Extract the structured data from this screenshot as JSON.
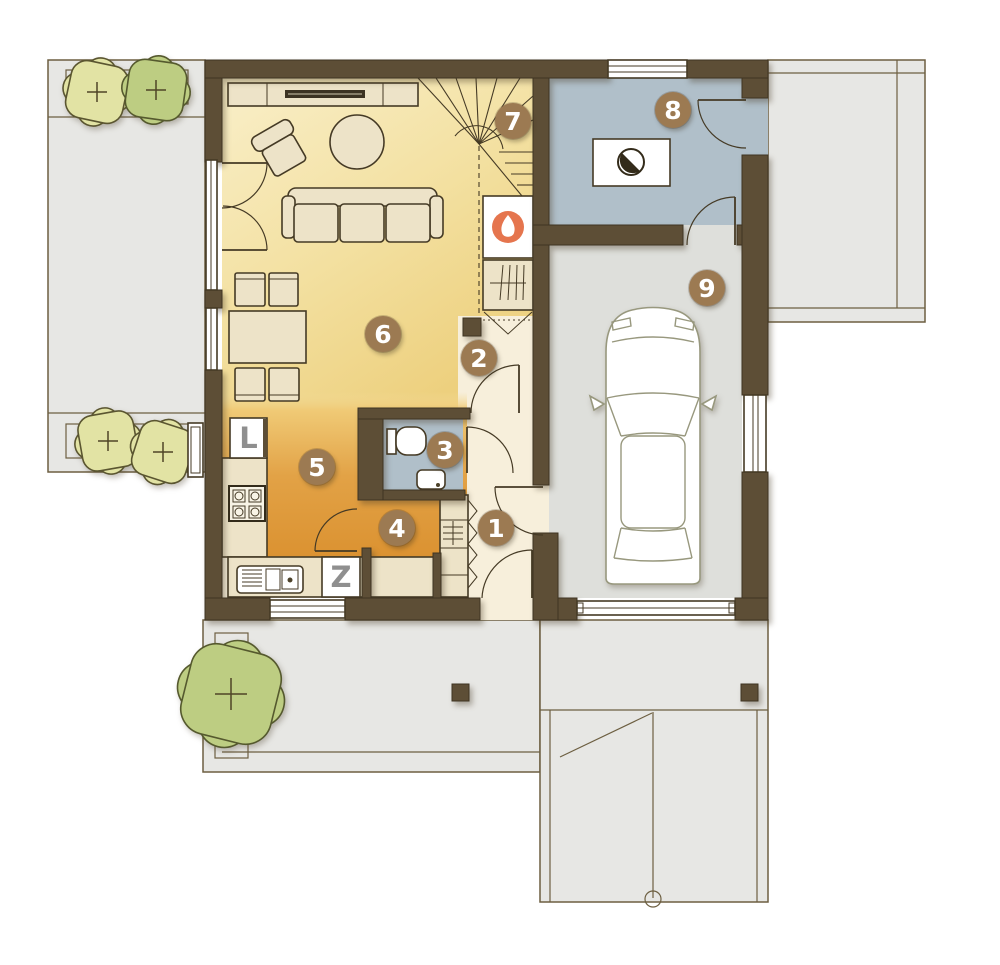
{
  "plan": {
    "rooms": [
      {
        "number": "1"
      },
      {
        "number": "2"
      },
      {
        "number": "3"
      },
      {
        "number": "4"
      },
      {
        "number": "5"
      },
      {
        "number": "6"
      },
      {
        "number": "7"
      },
      {
        "number": "8"
      },
      {
        "number": "9"
      }
    ],
    "appliances": {
      "fridge_label": "L",
      "dishwasher_label": "Z"
    },
    "icons": {
      "fireplace": "flame-icon",
      "boiler": "half-circle-contrast-icon",
      "plants": "plus-cross-icon"
    },
    "colors": {
      "wall": "#5d4e36",
      "outline": "#453a25",
      "hall": "#f7efdb",
      "bath": "#b0bfc9",
      "garage": "#dedfdb",
      "terrace": "#e7e7e4",
      "terrace_line": "#6d5f41",
      "furniture": "#ede3c8",
      "living_light": "#f9efc9",
      "living_deep": "#edd07e",
      "kitchen_light": "#f0ca76",
      "kitchen_deep": "#db9231",
      "badge": "#9c7a52",
      "badge_text": "#ffffff",
      "tree_yellow": "#e2e3a4",
      "tree_green": "#bdcd82",
      "flame": "#e5754e",
      "letter": "#8f8f8f",
      "car_line": "#98987e"
    }
  }
}
